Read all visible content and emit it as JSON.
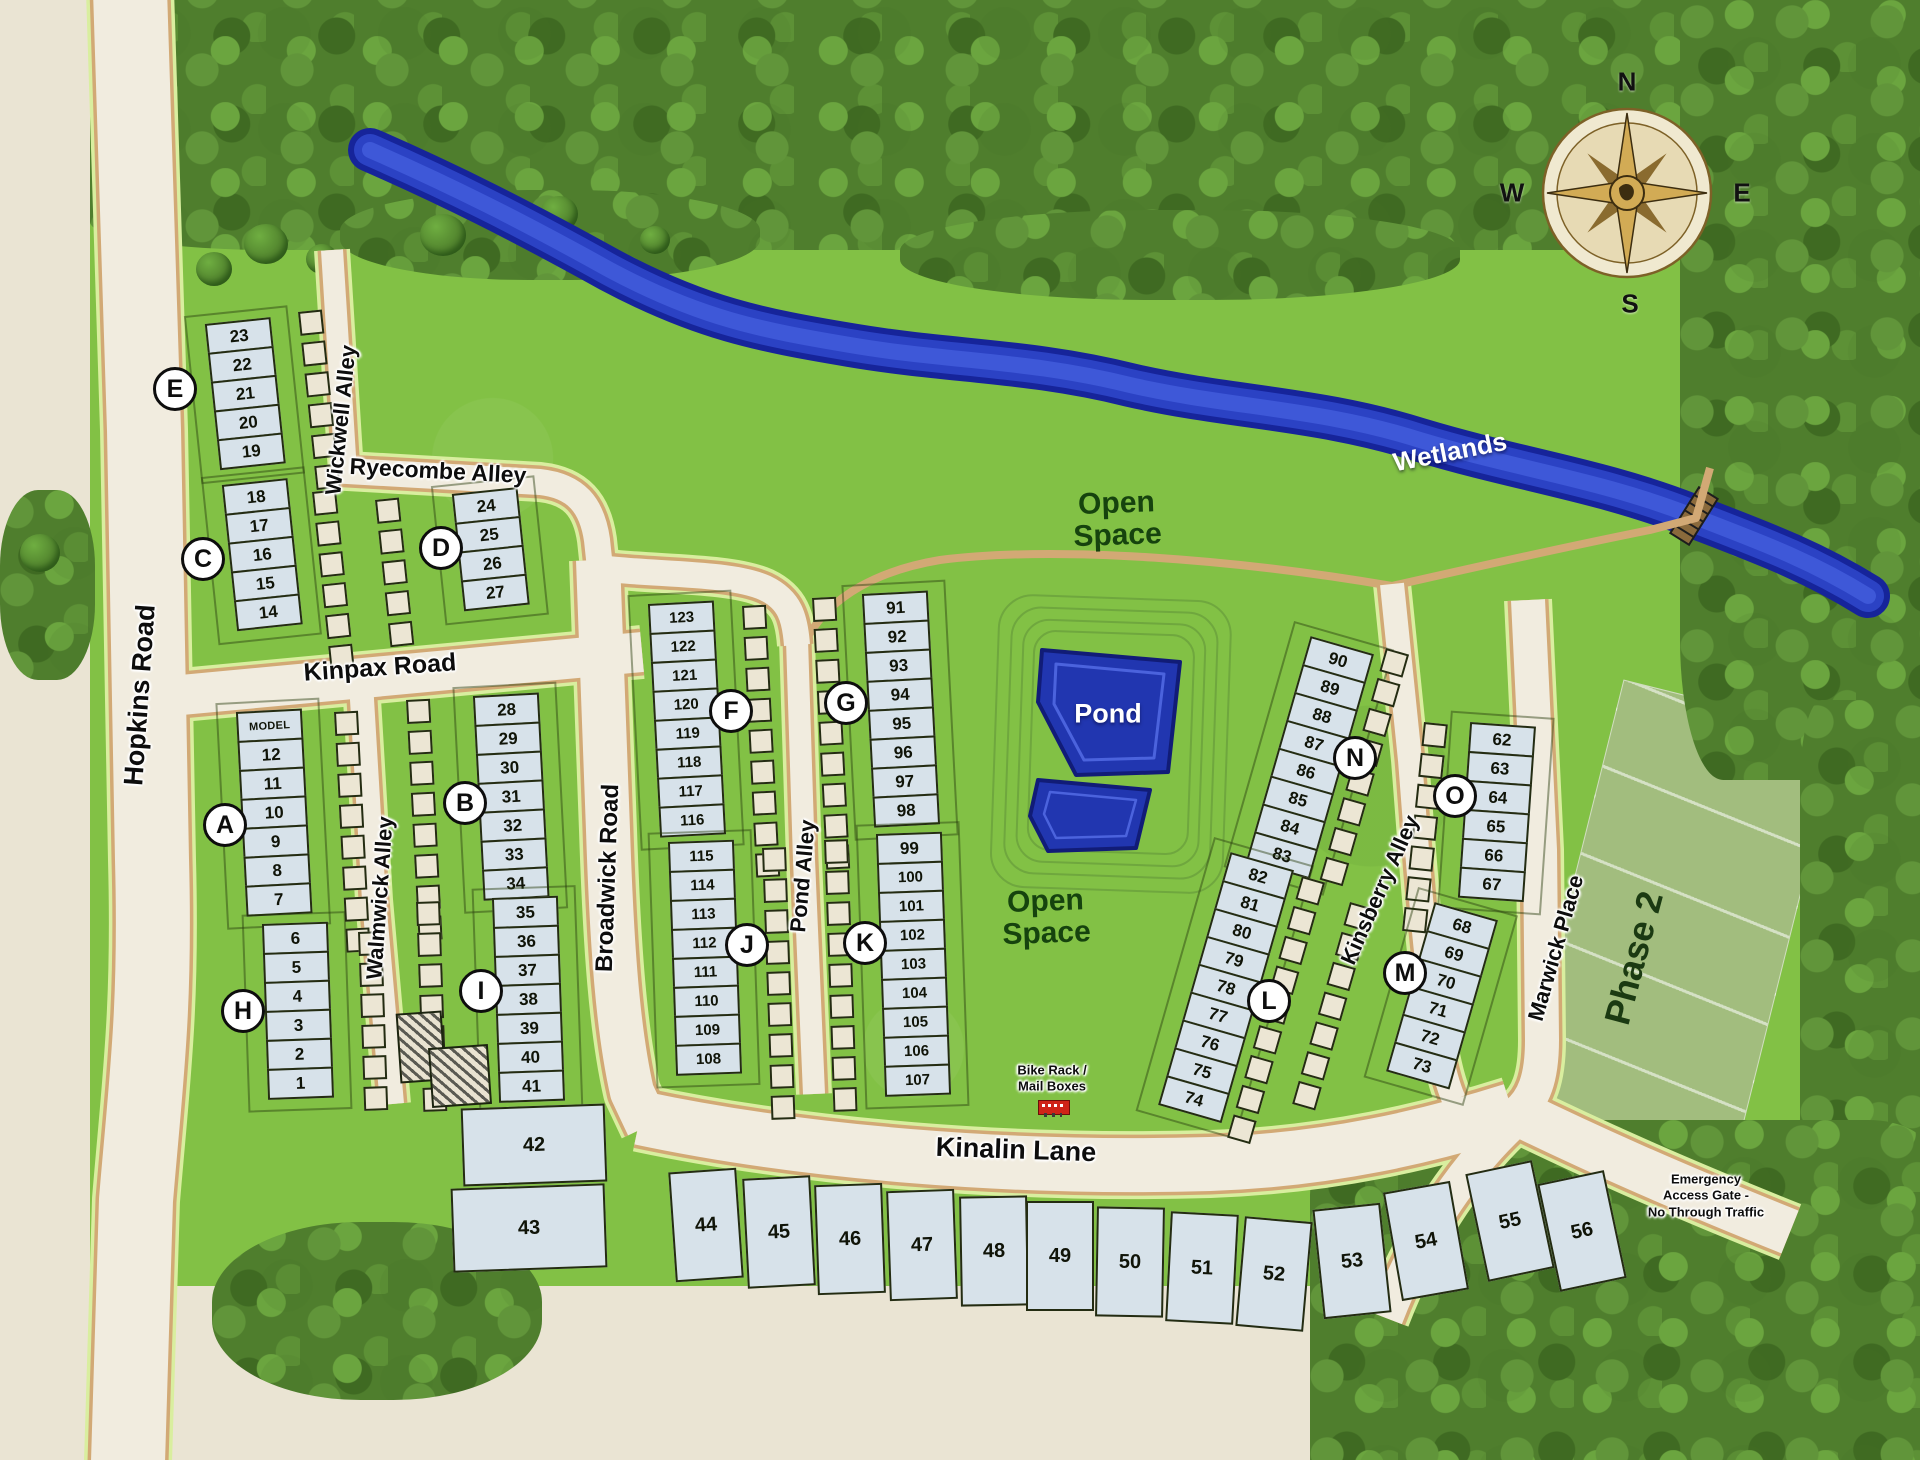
{
  "map": {
    "streets": {
      "hopkins": "Hopkins Road",
      "kinpax": "Kinpax Road",
      "ryecombe": "Ryecombe  Alley",
      "wickwell": "Wickwell  Alley",
      "walmwick": "Walmwick  Alley",
      "broadwick": "Broadwick  Road",
      "pond_alley": "Pond  Alley",
      "kinsberry": "Kinsberry  Alley",
      "marwick": "Marwick  Place",
      "kinalin": "Kinalin  Lane"
    },
    "labels": {
      "wetlands": "Wetlands",
      "pond": "Pond",
      "open_space_top": "Open\nSpace",
      "open_space_bottom": "Open\nSpace",
      "phase2": "Phase 2",
      "bike_rack": "Bike Rack /\nMail Boxes",
      "emergency": "Emergency\nAccess Gate -\nNo Through Traffic"
    },
    "compass": {
      "n": "N",
      "e": "E",
      "s": "S",
      "w": "W"
    },
    "blocks": [
      {
        "letter": "E",
        "lots": [
          "23",
          "22",
          "21",
          "20",
          "19"
        ]
      },
      {
        "letter": "C",
        "lots": [
          "18",
          "17",
          "16",
          "15",
          "14"
        ]
      },
      {
        "letter": "D",
        "lots": [
          "24",
          "25",
          "26",
          "27"
        ]
      },
      {
        "letter": "A",
        "lots": [
          "MODEL",
          "12",
          "11",
          "10",
          "9",
          "8",
          "7"
        ]
      },
      {
        "letter": "B",
        "lots": [
          "28",
          "29",
          "30",
          "31",
          "32",
          "33",
          "34"
        ]
      },
      {
        "letter": "H",
        "lots": [
          "6",
          "5",
          "4",
          "3",
          "2",
          "1"
        ]
      },
      {
        "letter": "I",
        "lots": [
          "35",
          "36",
          "37",
          "38",
          "39",
          "40",
          "41"
        ]
      },
      {
        "letter": "F",
        "lots": [
          "123",
          "122",
          "121",
          "120",
          "119",
          "118",
          "117",
          "116"
        ]
      },
      {
        "letter": "G",
        "lots": [
          "91",
          "92",
          "93",
          "94",
          "95",
          "96",
          "97",
          "98"
        ]
      },
      {
        "letter": "J",
        "lots": [
          "115",
          "114",
          "113",
          "112",
          "111",
          "110",
          "109",
          "108"
        ]
      },
      {
        "letter": "K",
        "lots": [
          "99",
          "100",
          "101",
          "102",
          "103",
          "104",
          "105",
          "106",
          "107"
        ]
      },
      {
        "letter": "N",
        "lots": [
          "90",
          "89",
          "88",
          "87",
          "86",
          "85",
          "84",
          "83"
        ]
      },
      {
        "letter": "O",
        "lots": [
          "62",
          "63",
          "64",
          "65",
          "66",
          "67"
        ]
      },
      {
        "letter": "L",
        "lots": [
          "82",
          "81",
          "80",
          "79",
          "78",
          "77",
          "76",
          "75",
          "74"
        ]
      },
      {
        "letter": "M",
        "lots": [
          "68",
          "69",
          "70",
          "71",
          "72",
          "73"
        ]
      }
    ],
    "outlots": [
      "42",
      "43"
    ],
    "south_lots": [
      "44",
      "45",
      "46",
      "47",
      "48",
      "49",
      "50",
      "51",
      "52",
      "53",
      "54",
      "55",
      "56"
    ],
    "colors": {
      "grass": "#82c145",
      "forest": "#4f7e2d",
      "road_surface": "#f1ecdf",
      "road_curb": "#d2a975",
      "road_glow": "#d9ee9f",
      "lot_fill": "#d7e2ea",
      "pond": "#2136b0",
      "stream": "#2b42c4",
      "phase2": "#a2bd7e",
      "bike_icon": "#cf2318"
    }
  }
}
